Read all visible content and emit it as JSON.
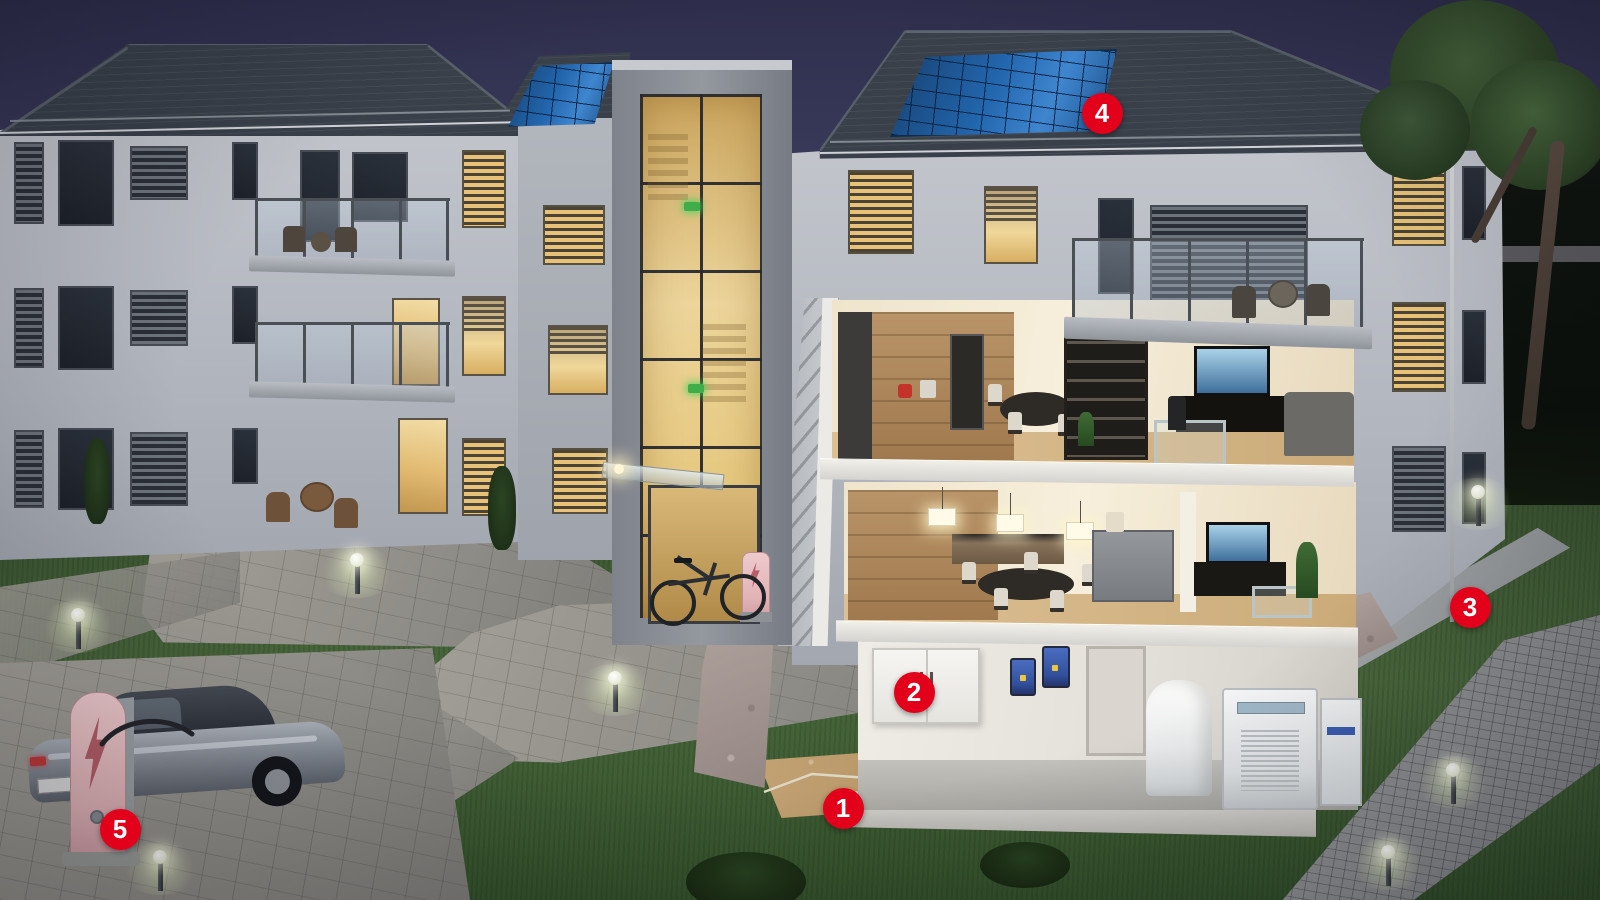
{
  "scene": {
    "description": "Dusk 3D cutaway illustration of a multi-family apartment building energy system with five numbered hotspots",
    "time_of_day": "dusk"
  },
  "palette": {
    "marker_red": "#e2001a",
    "marker_text": "#ffffff",
    "sky_top": "#2e2e4c",
    "sky_horizon": "#5e5e74",
    "roof": "#394049",
    "facade": "#b5b9c0",
    "solar_panel_blue": "#2266ad",
    "interior_warm": "#f0e3c4",
    "window_light": "#e7c277",
    "lawn_green": "#44603a",
    "paving_grey": "#99968f",
    "charger_pink": "#e9c3c6",
    "charger_bolt_red": "#b55e67",
    "inverter_blue": "#3a5db0",
    "exit_sign_green": "#3fae4a"
  },
  "icons": {
    "ev_charger": "lightning-arrow-icon",
    "bike_charger": "lightning-icon",
    "bollard": "sphere-lamp-icon",
    "exit_sign": "exit-light-icon"
  },
  "markers": [
    {
      "number": "1",
      "x": 843,
      "y": 808
    },
    {
      "number": "2",
      "x": 914,
      "y": 692
    },
    {
      "number": "3",
      "x": 1470,
      "y": 607
    },
    {
      "number": "4",
      "x": 1102,
      "y": 113
    },
    {
      "number": "5",
      "x": 120,
      "y": 829
    }
  ],
  "window_groups": [
    {
      "layer": "left-building-windows",
      "items": [
        {
          "x": 14,
          "y": 142,
          "w": 30,
          "h": 82,
          "kind": "louver-dark"
        },
        {
          "x": 58,
          "y": 140,
          "w": 56,
          "h": 86,
          "kind": "dark"
        },
        {
          "x": 130,
          "y": 146,
          "w": 58,
          "h": 54,
          "kind": "louver-dark"
        },
        {
          "x": 232,
          "y": 142,
          "w": 26,
          "h": 58,
          "kind": "dark"
        },
        {
          "x": 300,
          "y": 150,
          "w": 40,
          "h": 92,
          "kind": "dark"
        },
        {
          "x": 352,
          "y": 152,
          "w": 56,
          "h": 70,
          "kind": "dark"
        },
        {
          "x": 14,
          "y": 288,
          "w": 30,
          "h": 80,
          "kind": "louver-dark"
        },
        {
          "x": 58,
          "y": 286,
          "w": 56,
          "h": 84,
          "kind": "dark"
        },
        {
          "x": 130,
          "y": 290,
          "w": 58,
          "h": 56,
          "kind": "louver-dark"
        },
        {
          "x": 232,
          "y": 286,
          "w": 26,
          "h": 58,
          "kind": "dark"
        },
        {
          "x": 392,
          "y": 298,
          "w": 48,
          "h": 88,
          "kind": "lit"
        },
        {
          "x": 14,
          "y": 430,
          "w": 30,
          "h": 78,
          "kind": "louver-dark"
        },
        {
          "x": 58,
          "y": 428,
          "w": 56,
          "h": 82,
          "kind": "dark"
        },
        {
          "x": 130,
          "y": 432,
          "w": 58,
          "h": 74,
          "kind": "louver-dark"
        },
        {
          "x": 232,
          "y": 428,
          "w": 26,
          "h": 56,
          "kind": "dark"
        },
        {
          "x": 398,
          "y": 418,
          "w": 50,
          "h": 96,
          "kind": "lit"
        },
        {
          "x": 462,
          "y": 150,
          "w": 44,
          "h": 78,
          "kind": "louver-lit"
        },
        {
          "x": 462,
          "y": 296,
          "w": 44,
          "h": 80,
          "kind": "lit-blind"
        },
        {
          "x": 462,
          "y": 438,
          "w": 44,
          "h": 78,
          "kind": "louver-lit"
        }
      ]
    },
    {
      "layer": "mid-section-windows",
      "items": [
        {
          "x": 543,
          "y": 205,
          "w": 62,
          "h": 60,
          "kind": "louver-lit"
        },
        {
          "x": 548,
          "y": 325,
          "w": 60,
          "h": 70,
          "kind": "lit-blind"
        },
        {
          "x": 552,
          "y": 448,
          "w": 56,
          "h": 66,
          "kind": "louver-lit"
        }
      ]
    },
    {
      "layer": "right-building-windows",
      "items": [
        {
          "x": 848,
          "y": 170,
          "w": 66,
          "h": 84,
          "kind": "louver-lit"
        },
        {
          "x": 984,
          "y": 186,
          "w": 54,
          "h": 78,
          "kind": "lit-blind"
        },
        {
          "x": 1098,
          "y": 198,
          "w": 36,
          "h": 96,
          "kind": "dark"
        },
        {
          "x": 1150,
          "y": 205,
          "w": 158,
          "h": 126,
          "kind": "louver-dark"
        },
        {
          "x": 1392,
          "y": 158,
          "w": 54,
          "h": 88,
          "kind": "louver-lit"
        },
        {
          "x": 1462,
          "y": 166,
          "w": 24,
          "h": 74,
          "kind": "dark"
        },
        {
          "x": 1392,
          "y": 302,
          "w": 54,
          "h": 90,
          "kind": "louver-lit"
        },
        {
          "x": 1462,
          "y": 310,
          "w": 24,
          "h": 74,
          "kind": "dark"
        },
        {
          "x": 1392,
          "y": 446,
          "w": 54,
          "h": 86,
          "kind": "louver-dark"
        },
        {
          "x": 1462,
          "y": 452,
          "w": 24,
          "h": 72,
          "kind": "dark"
        }
      ]
    }
  ],
  "bollards": [
    {
      "x": 78,
      "y": 615
    },
    {
      "x": 160,
      "y": 857
    },
    {
      "x": 357,
      "y": 560
    },
    {
      "x": 615,
      "y": 678
    },
    {
      "x": 1453,
      "y": 770
    },
    {
      "x": 1388,
      "y": 852
    },
    {
      "x": 1478,
      "y": 492
    }
  ]
}
